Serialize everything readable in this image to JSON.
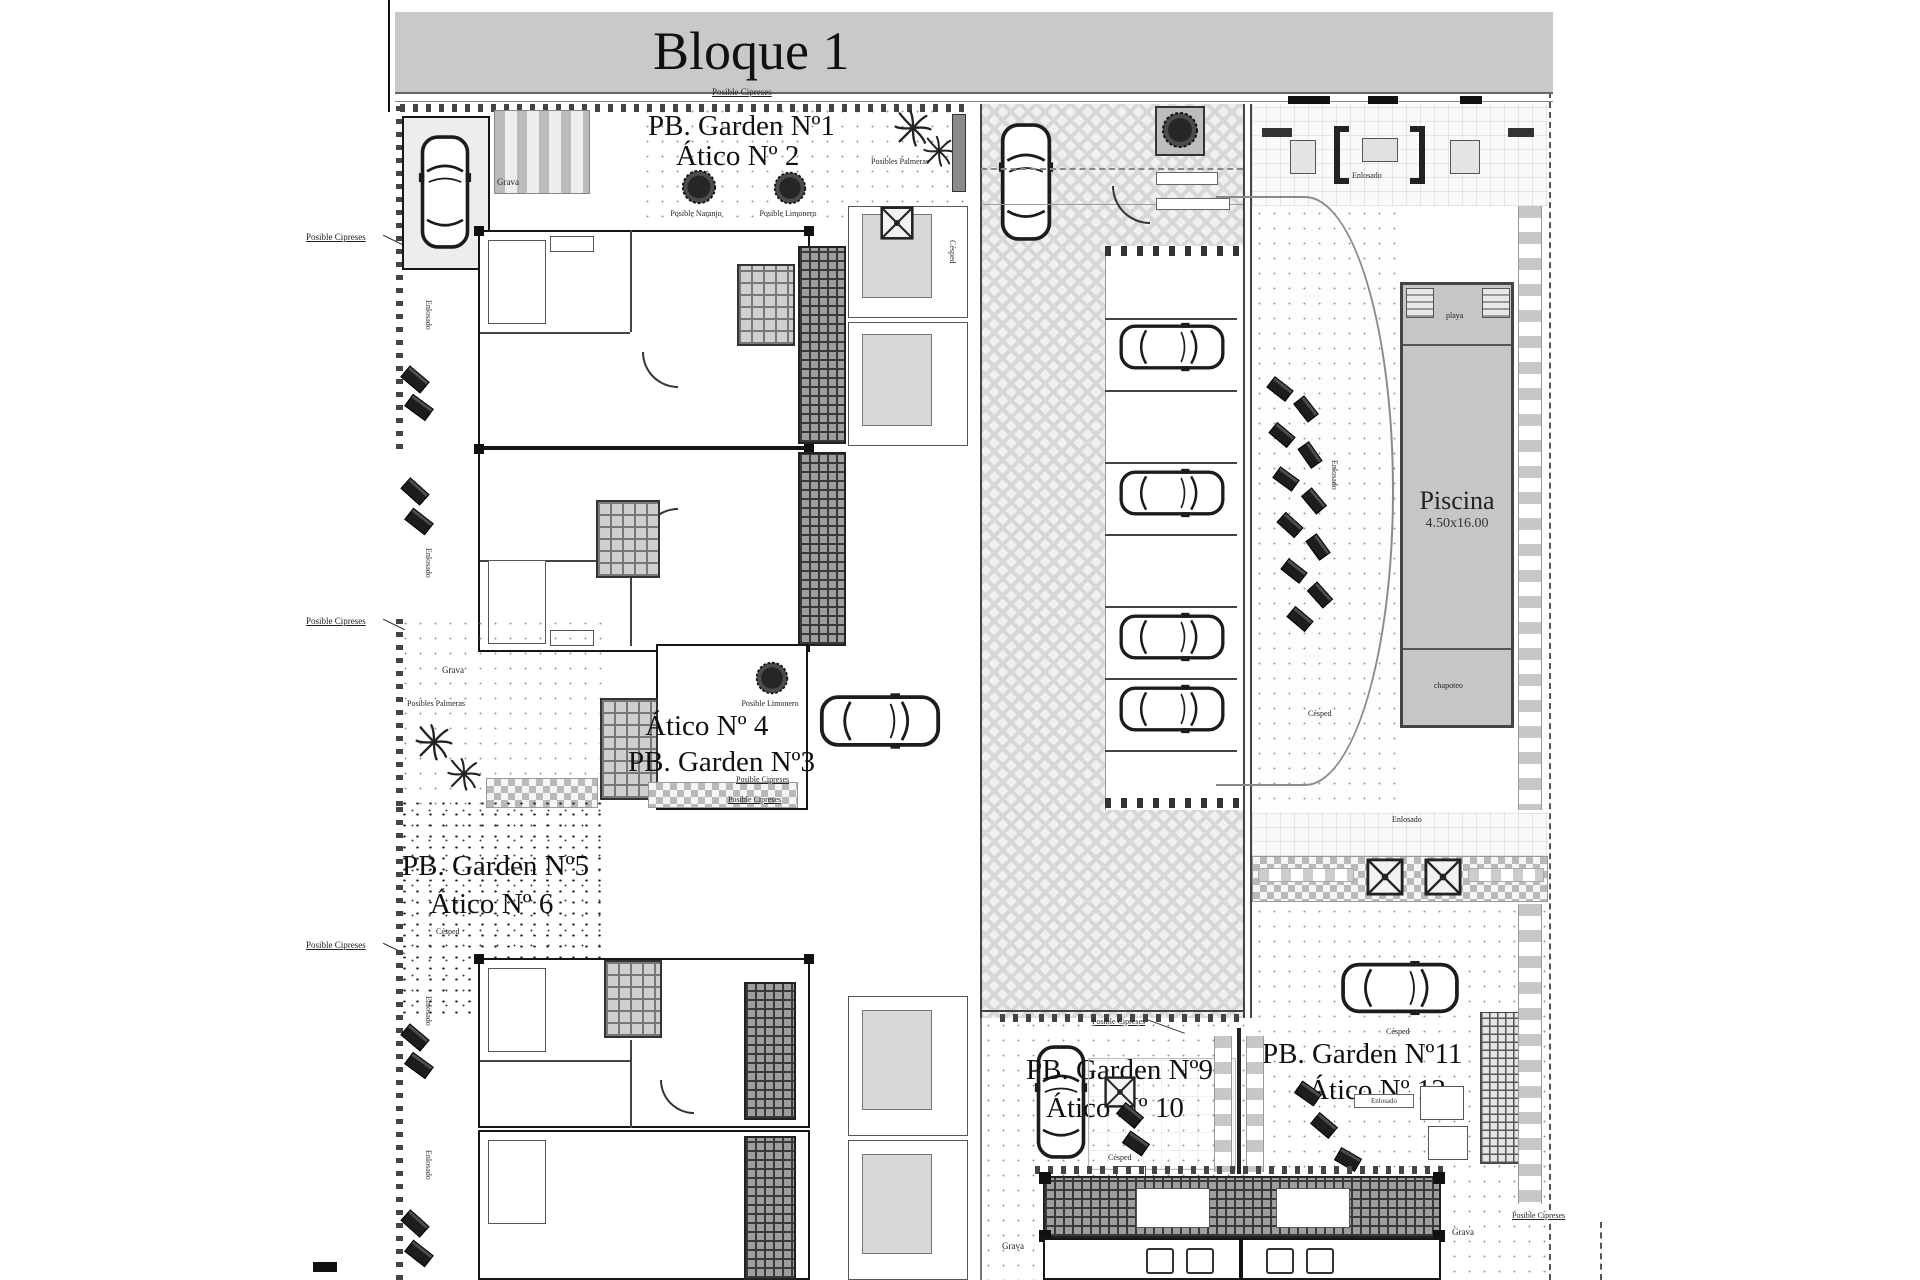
{
  "title": "Bloque 1",
  "units": {
    "u1a": "PB. Garden Nº1",
    "u1b": "Ático Nº 2",
    "u2a": "Ático Nº 4",
    "u2b": "PB. Garden Nº3",
    "u3a": "PB. Garden Nº5",
    "u3b": "Ático Nº 6",
    "u4a": "PB. Garden Nº9",
    "u4b": "Ático Nº 10",
    "u5a": "PB. Garden Nº11",
    "u5b": "Ático Nº 12"
  },
  "pool": {
    "name": "Piscina",
    "dims": "4.50x16.00",
    "top_zone": "playa",
    "bottom_zone": "chapoteo"
  },
  "labels": {
    "cipreses": "Posible Cipreses",
    "palmeras": "Posibles Palmeras",
    "naranjo": "Posible Naranjo",
    "limonero": "Posible Limonero",
    "grava": "Grava",
    "cesped": "Césped",
    "enlosado": "Enlosado"
  },
  "colors": {
    "paper": "#ffffff",
    "title_bar": "#c9c9c9",
    "pool_water": "#c6c6c6",
    "linework": "#1a1a1a"
  }
}
